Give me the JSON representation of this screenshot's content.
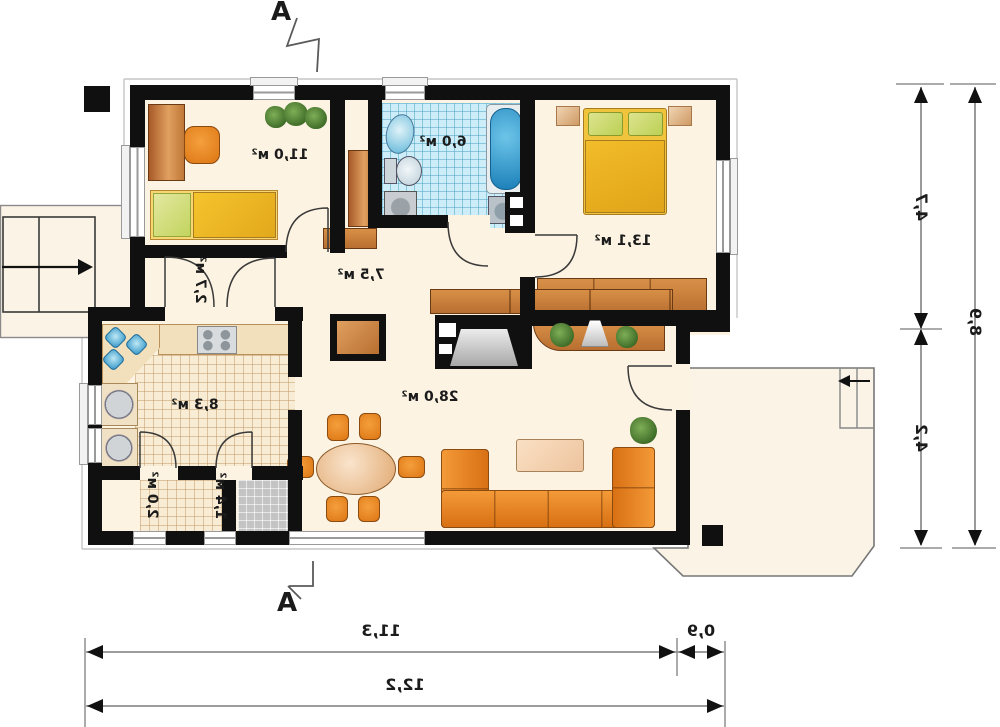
{
  "plan_title": "floor-plan",
  "sections": {
    "top": "A",
    "bottom": "A"
  },
  "rooms": {
    "study": {
      "label": "11,0 м²"
    },
    "bathroom": {
      "label": "6,0 м²"
    },
    "bedroom": {
      "label": "13,1 м²"
    },
    "corridor": {
      "label": "2,7 м²"
    },
    "hall": {
      "label": "7,5 м²"
    },
    "living": {
      "label": "28,0 м²"
    },
    "kitchen": {
      "label": "8,3 м²"
    },
    "pantry": {
      "label": "2,0 м²"
    },
    "entry": {
      "label": "1,4 м²"
    }
  },
  "dimensions": {
    "right_top": "4,7",
    "right_bottom": "4,2",
    "right_total": "8,9",
    "bottom_main": "11,3",
    "bottom_side": "0,9",
    "bottom_total": "12,2"
  },
  "colors": {
    "wall": "#101010",
    "floor": "#fcf3e2",
    "tile_blue": "#cdeef8",
    "wood": "#c9803f",
    "orange_furniture": "#e8872a",
    "bed_yellow": "#f0c03c",
    "dimension_line": "#8f8f8f"
  }
}
